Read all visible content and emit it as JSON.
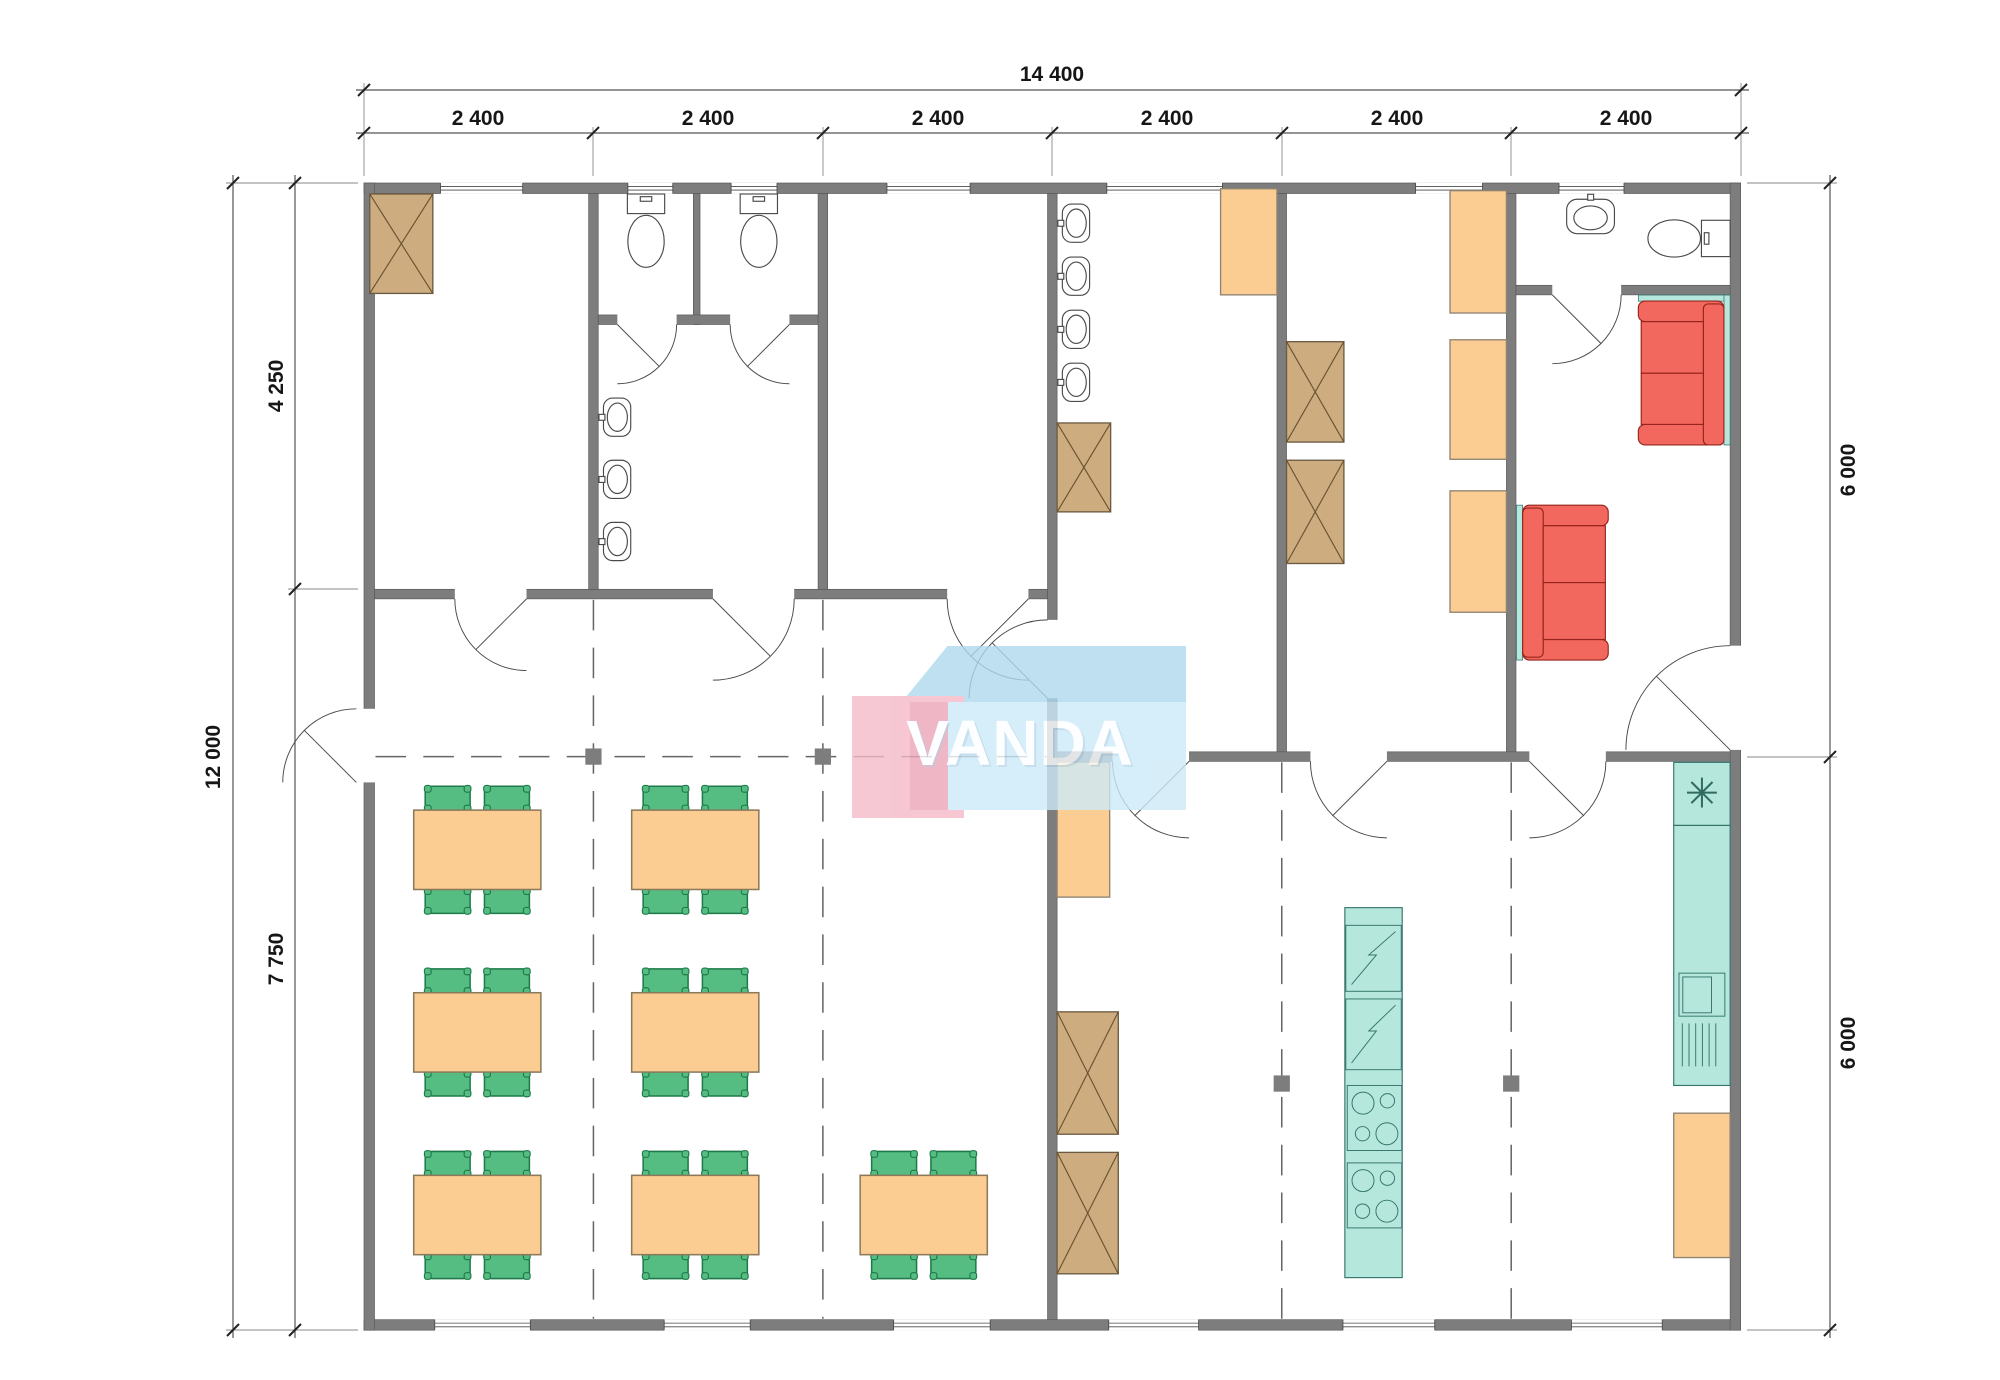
{
  "page": {
    "title": "Floor plan"
  },
  "watermark": {
    "text": "VANDA"
  },
  "dimensions": {
    "top_total": "14 400",
    "top_segments": [
      "2 400",
      "2 400",
      "2 400",
      "2 400",
      "2 400",
      "2 400"
    ],
    "left_total": "12 000",
    "left_upper": "4 250",
    "left_lower": "7 750",
    "right_upper": "6 000",
    "right_lower": "6 000"
  },
  "icons": {
    "freezer_symbol": "✳"
  },
  "colors": {
    "wall": "#7d7d7d",
    "wardrobe_tan": "#cdad80",
    "cabinet_orange": "#fbcd92",
    "chair_green": "#56bd82",
    "table_orange": "#fbcd92",
    "sofa_red": "#f2685e",
    "appliance_teal": "#b5e7dd",
    "watermark_blue": "#aed9ee",
    "watermark_pink": "#f4bac9"
  }
}
